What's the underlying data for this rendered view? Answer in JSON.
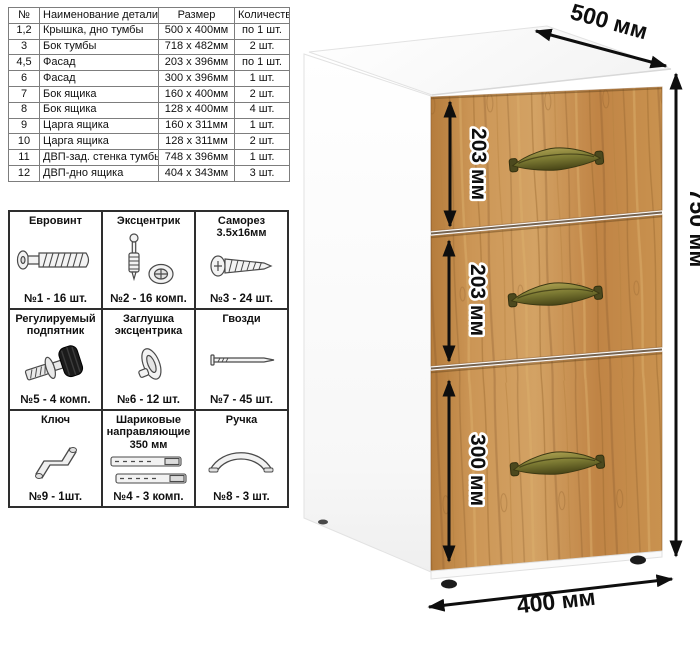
{
  "parts_table": {
    "headers": [
      "№",
      "Наименование детали",
      "Размер",
      "Количество"
    ],
    "rows": [
      {
        "num": "1,2",
        "name": "Крышка, дно тумбы",
        "size": "500 x 400мм",
        "qty": "по 1 шт."
      },
      {
        "num": "3",
        "name": "Бок тумбы",
        "size": "718 x 482мм",
        "qty": "2 шт."
      },
      {
        "num": "4,5",
        "name": "Фасад",
        "size": "203 x 396мм",
        "qty": "по 1 шт."
      },
      {
        "num": "6",
        "name": "Фасад",
        "size": "300 x 396мм",
        "qty": "1 шт."
      },
      {
        "num": "7",
        "name": "Бок ящика",
        "size": "160 x 400мм",
        "qty": "2 шт."
      },
      {
        "num": "8",
        "name": "Бок ящика",
        "size": "128 x 400мм",
        "qty": "4 шт."
      },
      {
        "num": "9",
        "name": "Царга ящика",
        "size": "160 x 311мм",
        "qty": "1 шт."
      },
      {
        "num": "10",
        "name": "Царга ящика",
        "size": "128 x 311мм",
        "qty": "2 шт."
      },
      {
        "num": "11",
        "name": "ДВП-зад. стенка тумбы",
        "size": "748 x 396мм",
        "qty": "1 шт."
      },
      {
        "num": "12",
        "name": "ДВП-дно ящика",
        "size": "404 x 343мм",
        "qty": "3 шт."
      }
    ]
  },
  "hardware": {
    "items": [
      {
        "title": "Евровинт",
        "icon": "euro-screw-icon",
        "count": "№1 - 16 шт."
      },
      {
        "title": "Эксцентрик",
        "icon": "cam-lock-icon",
        "count": "№2 - 16 комп."
      },
      {
        "title": "Саморез 3.5х16мм",
        "icon": "self-tapping-screw-icon",
        "count": "№3 - 24 шт."
      },
      {
        "title": "Регулируемый подпятник",
        "icon": "adjustable-foot-icon",
        "count": "№5 - 4 комп."
      },
      {
        "title": "Заглушка эксцентрика",
        "icon": "cam-cover-icon",
        "count": "№6 - 12 шт."
      },
      {
        "title": "Гвозди",
        "icon": "nail-icon",
        "count": "№7 - 45 шт."
      },
      {
        "title": "Ключ",
        "icon": "key-icon",
        "count": "№9 - 1шт."
      },
      {
        "title": "Шариковые направляющие 350 мм",
        "icon": "ball-slides-icon",
        "count": "№4 - 3 комп."
      },
      {
        "title": "Ручка",
        "icon": "handle-icon",
        "count": "№8 - 3 шт."
      }
    ]
  },
  "cabinet": {
    "dimensions": {
      "depth": "500 мм",
      "height": "750 мм",
      "width": "400 мм",
      "drawer1": "203 мм",
      "drawer2": "203 мм",
      "drawer3": "300 мм"
    },
    "colors": {
      "wood": "#c8914f",
      "wood_dark": "#8a5a28",
      "wood_light": "#dfb273",
      "handle_brass": "#7c7a33",
      "body_white": "#ffffff",
      "dimension_black": "#0e0e0e"
    }
  }
}
